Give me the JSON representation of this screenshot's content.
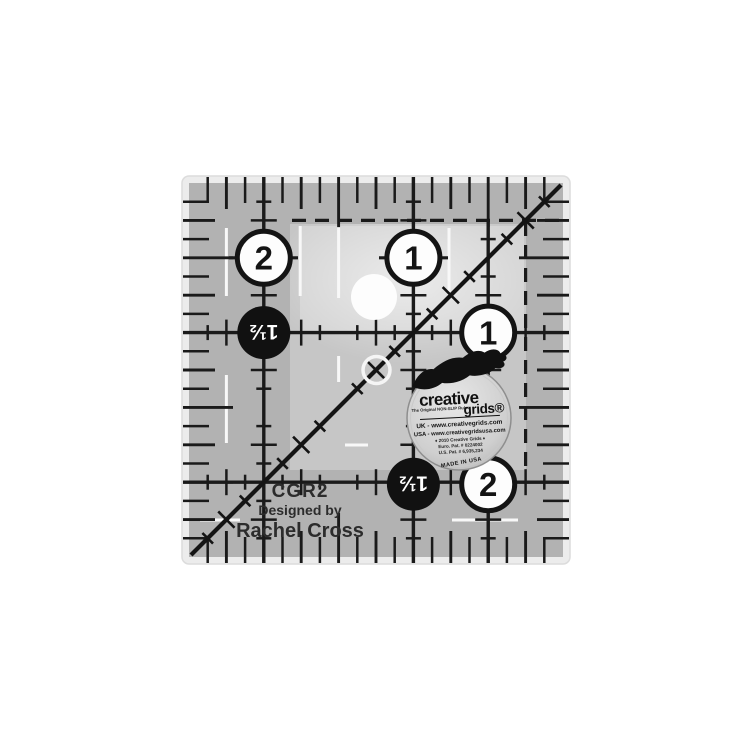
{
  "ruler": {
    "model": "CGR2",
    "designed_by_label": "Designed by",
    "designer": "Rachel Cross",
    "badges": {
      "top_left": "2",
      "top_mid": "1",
      "right_mid": "1",
      "bottom_right": "2",
      "half_left": "1½",
      "half_bottom": "1½"
    }
  },
  "sticker": {
    "pretitle": "Turn a Round™",
    "brand_word1": "creative",
    "brand_word2": "grids®",
    "tagline": "The Original NON-SLIP Ruler",
    "uk_line": "UK - www.creativegrids.com",
    "usa_line": "USA - www.creativegridsusa.com",
    "copyright_line": "♦ 2010 Creative Grids ♦",
    "euro_patent_line": "Euro. Pat. # 0224002",
    "us_patent_line": "U.S. Pat. # 6,935,234",
    "made_in": "MADE IN USA"
  },
  "colors": {
    "background": "#ffffff",
    "ruler_band": "#b2b2b2",
    "ruler_interior": "#c6c6c6",
    "ruler_highlight": "#d3d3d3",
    "ink": "#1a1a1a",
    "white_marks": "#f8f8f8"
  }
}
